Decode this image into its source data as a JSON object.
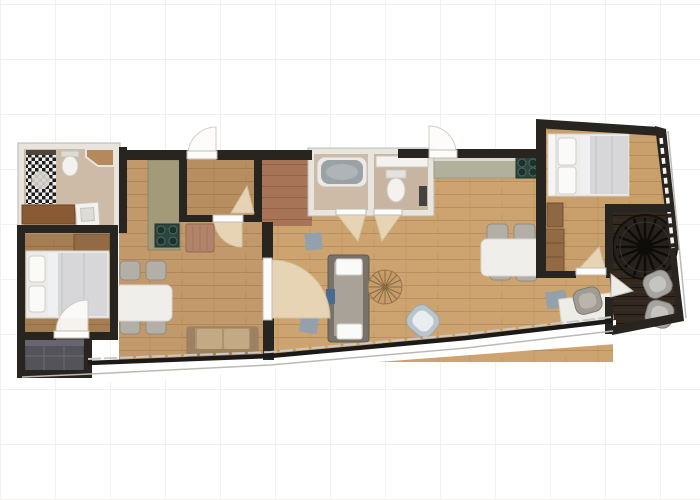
{
  "image": {
    "kind": "apartment-floor-plan",
    "width_px": 700,
    "height_px": 500,
    "visible_text": "none",
    "background": "white with faint tile grid"
  },
  "colors": {
    "wall_dark": "#28241f",
    "wall_light": "#e8e5df",
    "floor_living": "#cda46f",
    "floor_dining": "#c2996a",
    "floor_vestibule": "#b78e60",
    "floor_corridor": "#a87457",
    "floor_bedroom_left": "#a57d53",
    "floor_bedroom_right": "#c9a06c",
    "floor_bath": "#cdbba8",
    "floor_wc": "#c7b5a1",
    "floor_balcony": "#59554f",
    "terrace_deck": "#322820",
    "counter_olive": "#a29a79",
    "counter_sage": "#b1b09c",
    "counter_saddle": "#8a5a35",
    "hob_teal": "#2c463f",
    "fixture_white": "#f4f2ee",
    "tub_basin": "#9aa2a6",
    "fan_beige": "#ead9bc",
    "leaf_white": "#fdfcfa",
    "table_white": "#f0eeea",
    "chair_gray": "#b3afa7",
    "sofa_tan": "#ad9371",
    "sofa_tan_cushion": "#c3aa85",
    "sofa_gray_frame": "#797269",
    "sofa_gray_seat": "#a9a299",
    "sofa_dark": "#54535a",
    "blanket_gray": "#d7d7d9",
    "pillow_white": "#fafaf8",
    "wood_table": "#c59d6a",
    "armchair_blue": "#bac5cb",
    "mat_blue": "#94a1ad",
    "cabinet_brown": "#8e6743",
    "wardrobe_brown": "#926b45",
    "radiator_tan": "#b28368",
    "lounge_gray": "#a6a4a0",
    "fan_disc": "#26211c",
    "glass_dark": "#1c1a18",
    "line_light": "#bdbab4"
  },
  "floor_plan": {
    "rooms": [
      {
        "id": "bathroom-left",
        "features": [
          "checker-tile-shower",
          "shower-drain",
          "toilet",
          "corner-wood-cabinet",
          "saddle-counter",
          "vanity-sink"
        ]
      },
      {
        "id": "bedroom-left",
        "features": [
          "double-bed",
          "pillows",
          "wardrobe",
          "door-swing"
        ]
      },
      {
        "id": "balcony-nook",
        "features": [
          "dark-corner-sofa"
        ]
      },
      {
        "id": "hall-dining",
        "features": [
          "olive-kitchen-counter",
          "hob-4-burner",
          "dining-table",
          "4-chairs",
          "tan-sofa",
          "radiator-cabinet"
        ]
      },
      {
        "id": "entry-vestibule",
        "features": [
          "entry-door-arc",
          "inner-door-swing"
        ]
      },
      {
        "id": "red-corridor",
        "features": [
          "red-wood-floor"
        ]
      },
      {
        "id": "bathroom-center",
        "features": [
          "bathtub",
          "door-swing"
        ]
      },
      {
        "id": "wc",
        "features": [
          "vanity-counter",
          "toilet",
          "radiator",
          "door-swing"
        ]
      },
      {
        "id": "living-room",
        "features": [
          "gray-sofa",
          "round-wood-coffee-table",
          "blue-armchair",
          "two-floor-mats",
          "sage-kitchen-counter",
          "hob-4-burner",
          "dining-table",
          "4-chairs",
          "desk",
          "desk-chair",
          "desk-mat",
          "second-entry-door-arc",
          "glass-window-wall"
        ]
      },
      {
        "id": "bedroom-right",
        "features": [
          "double-bed",
          "pillows",
          "nightstand",
          "wardrobe",
          "diagonal-window-wall",
          "door-swing"
        ]
      },
      {
        "id": "terrace",
        "features": [
          "dark-deck",
          "round-spoke-fan-feature",
          "two-lounge-chairs",
          "door-swing"
        ]
      }
    ]
  }
}
